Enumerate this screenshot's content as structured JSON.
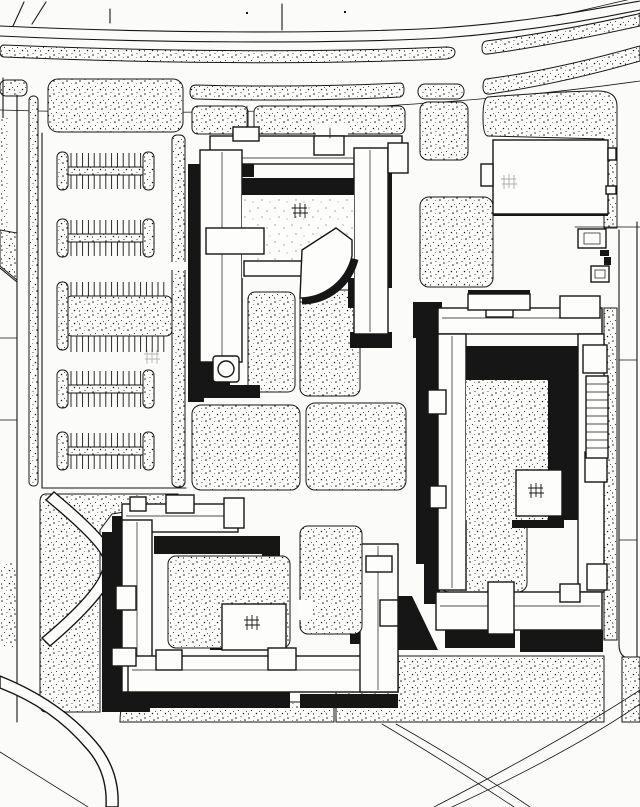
{
  "title": "Black-and-white architectural campus site plan with shadowed courtyard buildings, parking field and curving roads",
  "colors": {
    "ink": "#161616",
    "paper": "#fbfbf9",
    "paperhi": "#fdfdfc"
  },
  "drawing": {
    "type": "site-plan",
    "style": "ink drawing, stippled landscape, solid black cast shadows toward lower-left",
    "buildings": [
      {
        "id": "north-courtyard-building",
        "features": [
          "U-shaped wings",
          "fan-shaped hall in courtyard",
          "rooftop pavilions",
          "cylindrical stair drum",
          "tree-grid planting in court"
        ]
      },
      {
        "id": "northeast-hall",
        "features": [
          "rectangular block",
          "entry tab on west side",
          "service yard with two framed enclosures"
        ]
      },
      {
        "id": "east-courtyard-building",
        "features": [
          "rectangular ring of wings",
          "stippled courtyard",
          "corner pavilion with tree grid",
          "exterior stair run on east side"
        ]
      },
      {
        "id": "southwest-courtyard-building",
        "features": [
          "C-shaped wings",
          "courtyard pavilion with tree grid",
          "east stub wing"
        ]
      }
    ],
    "parking": {
      "rows": 5,
      "wide_planted_median_row": 3,
      "stall_ticks_per_row": 13
    },
    "roads": {
      "north_arterial_lines": 2,
      "stippled_medians": 2,
      "curve_direction": "sweeping up to the north-east corner"
    },
    "landscape": {
      "stippled_panels": 18,
      "tree_grids": 5,
      "curved_footpaths_southwest": 2,
      "crossing_footpaths_southeast": 2
    }
  }
}
